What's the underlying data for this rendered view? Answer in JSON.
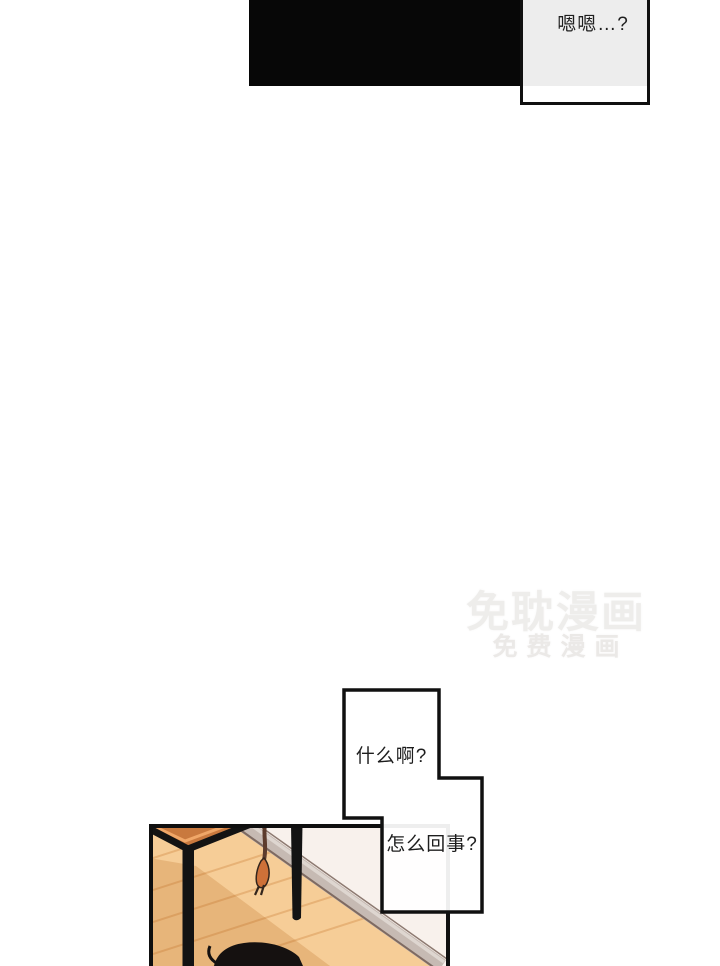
{
  "bubbles": {
    "top": "嗯嗯…?",
    "what": "什么啊?",
    "whats_going_on": "怎么回事?"
  },
  "watermark": {
    "line1": "免耽漫画",
    "line2": "免费漫画"
  },
  "colors": {
    "page_background": "#ffffff",
    "top_panel_black": "#070707",
    "bubble_fill": "rgba(255,255,255,0.93)",
    "bubble_border": "#101010",
    "panel_border": "#0f0f0f",
    "floor": "#f6cd97",
    "floor_shadow": "rgba(176,94,22,0.22)",
    "plank_line": "#e3a96b",
    "wall": "#f8f1ec",
    "baseboard": "#c6bab3",
    "tabletop": "#c9793e",
    "tabletop_highlight": "#f0a768",
    "table_leg": "#131313",
    "cord": "#5d3c2d",
    "plug": "#ce7138",
    "character_hair": "#151110",
    "watermark_text": "#eeedeb"
  }
}
